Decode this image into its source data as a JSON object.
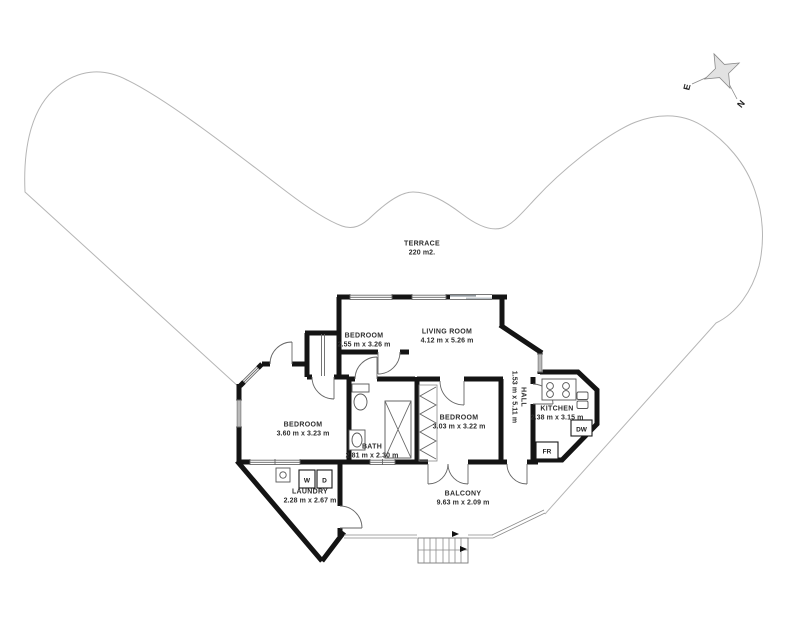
{
  "colors": {
    "wall": "#141414",
    "thin": "#666666",
    "terrace_line": "#b5b5b5",
    "label": "#2e2e2e",
    "slider": "#8f979d"
  },
  "terrace": {
    "name": "TERRACE",
    "area": "220 m2."
  },
  "compass": {
    "east": "E",
    "north": "N"
  },
  "rooms": [
    {
      "id": "bedroom-top",
      "name": "BEDROOM",
      "dims": "2.55 m x 3.26 m"
    },
    {
      "id": "living-room",
      "name": "LIVING ROOM",
      "dims": "4.12 m x 5.26 m"
    },
    {
      "id": "bedroom-left",
      "name": "BEDROOM",
      "dims": "3.60 m x 3.23 m"
    },
    {
      "id": "bath",
      "name": "BATH",
      "dims": "2.81 m x 2.30 m"
    },
    {
      "id": "bedroom-middle",
      "name": "BEDROOM",
      "dims": "3.03 m x 3.22 m"
    },
    {
      "id": "hall",
      "name": "HALL",
      "dims": "1.53 m x 5.11 m"
    },
    {
      "id": "kitchen",
      "name": "KITCHEN",
      "dims": "2.38 m x 3.15 m"
    },
    {
      "id": "laundry",
      "name": "LAUNDRY",
      "dims": "2.28 m x 2.67 m"
    },
    {
      "id": "balcony",
      "name": "BALCONY",
      "dims": "9.63 m x 2.09 m"
    }
  ],
  "appliances": {
    "washer": "W",
    "dryer": "D",
    "dishwasher": "DW",
    "fridge": "FR"
  }
}
